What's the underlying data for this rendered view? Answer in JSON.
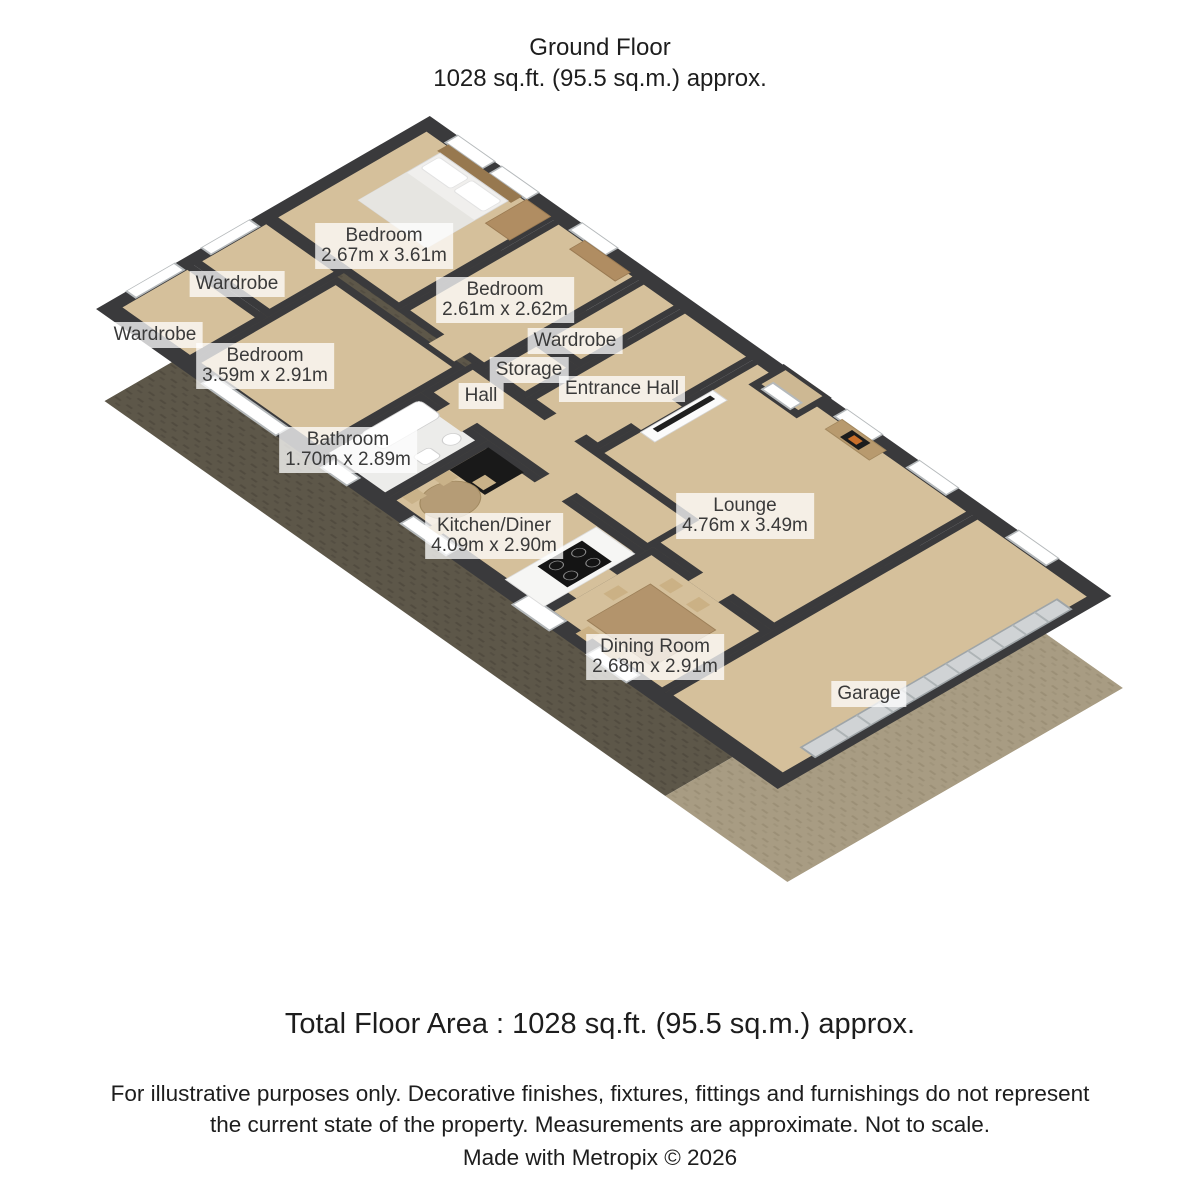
{
  "header": {
    "title": "Ground Floor",
    "subtitle": "1028 sq.ft. (95.5 sq.m.) approx."
  },
  "plan": {
    "rooms": [
      {
        "id": "bedroom-1",
        "name": "Bedroom",
        "dims": "2.67m x 3.61m",
        "label_x": 384,
        "label_y": 246
      },
      {
        "id": "wardrobe-a",
        "name": "Wardrobe",
        "dims": "",
        "label_x": 237,
        "label_y": 284
      },
      {
        "id": "wardrobe-b",
        "name": "Wardrobe",
        "dims": "",
        "label_x": 155,
        "label_y": 335
      },
      {
        "id": "bedroom-2",
        "name": "Bedroom",
        "dims": "2.61m x 2.62m",
        "label_x": 505,
        "label_y": 300
      },
      {
        "id": "wardrobe-c",
        "name": "Wardrobe",
        "dims": "",
        "label_x": 575,
        "label_y": 341
      },
      {
        "id": "storage",
        "name": "Storage",
        "dims": "",
        "label_x": 529,
        "label_y": 370
      },
      {
        "id": "bedroom-3",
        "name": "Bedroom",
        "dims": "3.59m x 2.91m",
        "label_x": 265,
        "label_y": 366
      },
      {
        "id": "hall",
        "name": "Hall",
        "dims": "",
        "label_x": 481,
        "label_y": 396
      },
      {
        "id": "entrance-hall",
        "name": "Entrance Hall",
        "dims": "",
        "label_x": 622,
        "label_y": 389
      },
      {
        "id": "bathroom",
        "name": "Bathroom",
        "dims": "1.70m x 2.89m",
        "label_x": 348,
        "label_y": 450
      },
      {
        "id": "kitchen-diner",
        "name": "Kitchen/Diner",
        "dims": "4.09m x 2.90m",
        "label_x": 494,
        "label_y": 536
      },
      {
        "id": "lounge",
        "name": "Lounge",
        "dims": "4.76m x 3.49m",
        "label_x": 745,
        "label_y": 516
      },
      {
        "id": "dining-room",
        "name": "Dining Room",
        "dims": "2.68m x 2.91m",
        "label_x": 655,
        "label_y": 657
      },
      {
        "id": "garage",
        "name": "Garage",
        "dims": "",
        "label_x": 869,
        "label_y": 694
      }
    ]
  },
  "footer": {
    "total_area": "Total Floor Area : 1028 sq.ft. (95.5 sq.m.) approx.",
    "disclaimer": "For illustrative purposes only. Decorative finishes, fixtures, fittings and furnishings do not represent the current state of the property. Measurements are approximate. Not to scale.",
    "credit": "Made with Metropix © 2026"
  },
  "colors": {
    "wall": "#3a3a3c",
    "floor": "#d5c09b",
    "bathroom_floor": "#ececea",
    "exterior_main": "#5d5749",
    "exterior_garage": "#a89c83",
    "label_bg": "rgba(255,255,255,0.75)"
  }
}
